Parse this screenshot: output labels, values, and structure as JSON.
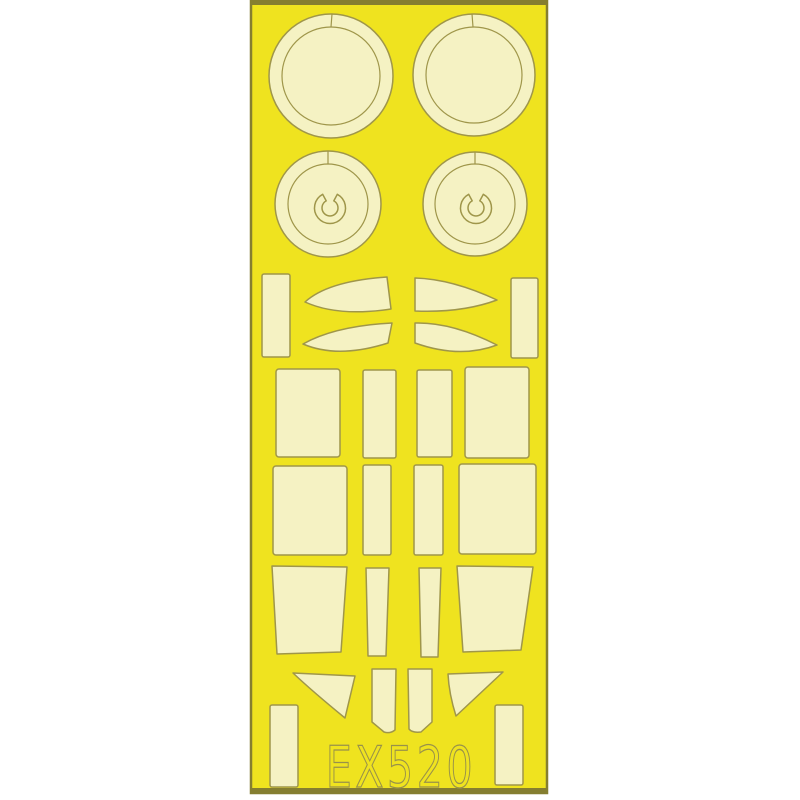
{
  "sheet": {
    "code": "EX520"
  },
  "colors": {
    "page_background": "#ffffff",
    "sheet_yellow": "#efe31f",
    "mask_cream": "#f5f2c3",
    "cut_outline": "#9f964a",
    "sheet_edge": "#857e30",
    "code_text": "#98914a"
  },
  "pieces": {
    "large_circle_masks": 2,
    "circle_masks_with_u_cutout": 2,
    "curved_blade_masks": 4,
    "rectangle_and_trapezoid_masks": 16,
    "triangle_masks": 2,
    "shield_panel_masks": 2
  }
}
